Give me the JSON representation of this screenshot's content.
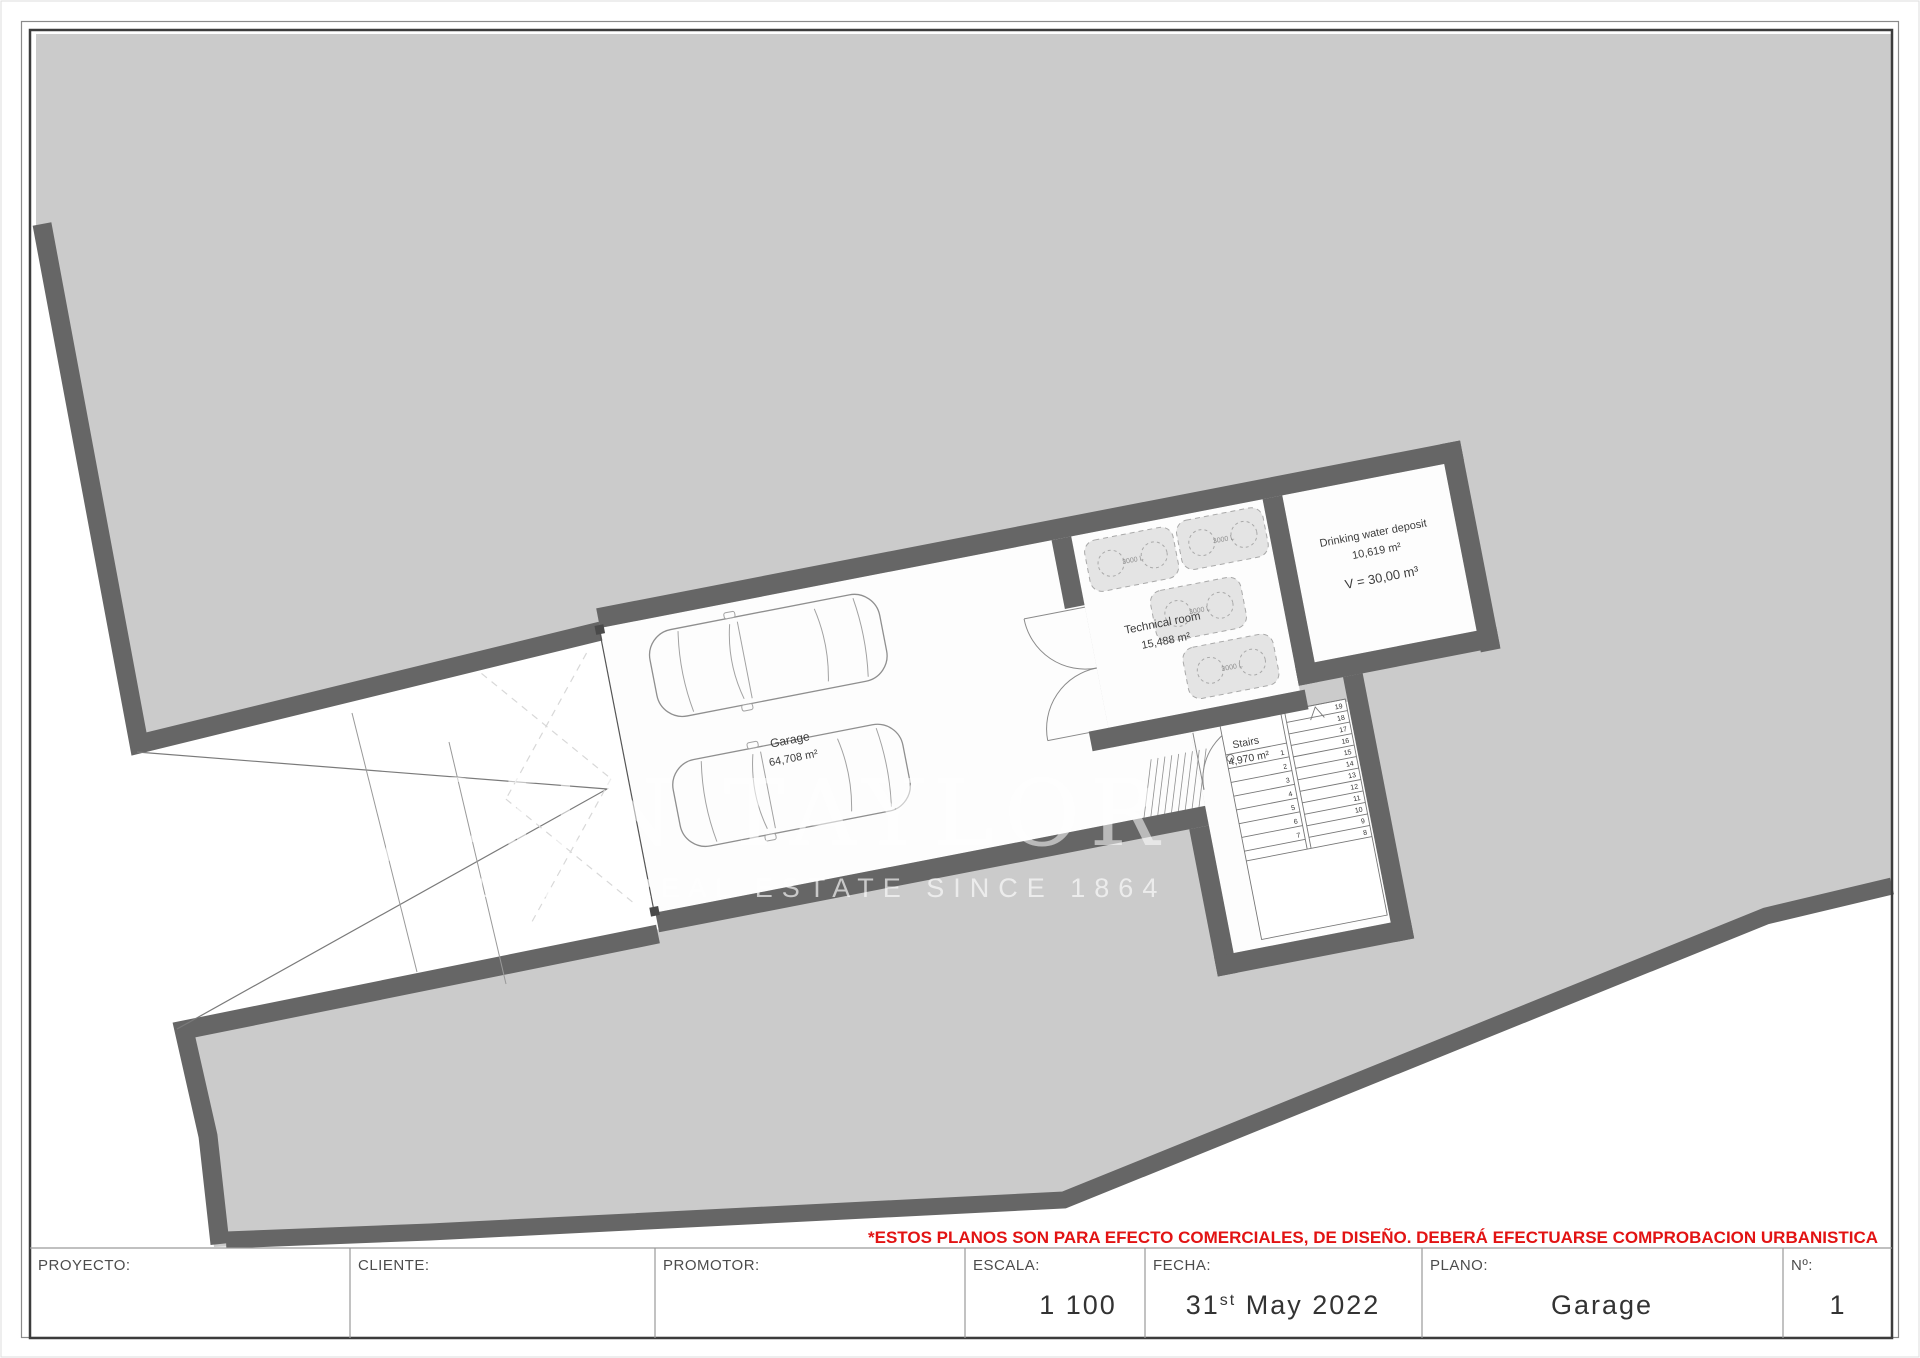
{
  "title_block": {
    "proyecto_label": "PROYECTO:",
    "cliente_label": "CLIENTE:",
    "promotor_label": "PROMOTOR:",
    "escala_label": "ESCALA:",
    "escala_value": "1 100",
    "fecha_label": "FECHA:",
    "fecha_day": "31",
    "fecha_sup": "st",
    "fecha_rest": " May 2022",
    "plano_label": "PLANO:",
    "plano_value": "Garage",
    "numero_label": "Nº:",
    "numero_value": "1"
  },
  "disclaimer": {
    "text": "*ESTOS PLANOS SON PARA EFECTO COMERCIALES, DE DISEÑO. DEBERÁ EFECTUARSE COMPROBACION URBANISTICA",
    "color": "#e21313"
  },
  "watermark": {
    "brand": "JOHN TAYLOR",
    "tagline": "LUXURY REAL ESTATE SINCE 1864"
  },
  "plan": {
    "rooms": {
      "garage": {
        "name": "Garage",
        "area": "64,708 m²"
      },
      "technical": {
        "name": "Technical room",
        "area": "15,488 m²"
      },
      "water": {
        "name": "Drinking water deposit",
        "area": "10,619 m²",
        "volume": "V = 30,00 m³"
      },
      "stairs": {
        "name": "Stairs",
        "area": "4,970 m²"
      }
    },
    "tanks": [
      {
        "label": "3000 L"
      },
      {
        "label": "3000 L"
      },
      {
        "label": "3000 L"
      },
      {
        "label": "3000 L"
      }
    ],
    "stair_steps": {
      "flight_a": [
        "1",
        "2",
        "3",
        "4",
        "5",
        "6",
        "7"
      ],
      "flight_b": [
        "8",
        "9",
        "10",
        "11",
        "12",
        "13",
        "14",
        "15",
        "16",
        "17",
        "18",
        "19"
      ]
    },
    "colors": {
      "earth": "#cbcbcb",
      "wall": "#666666",
      "room": "#fdfdfd"
    }
  }
}
